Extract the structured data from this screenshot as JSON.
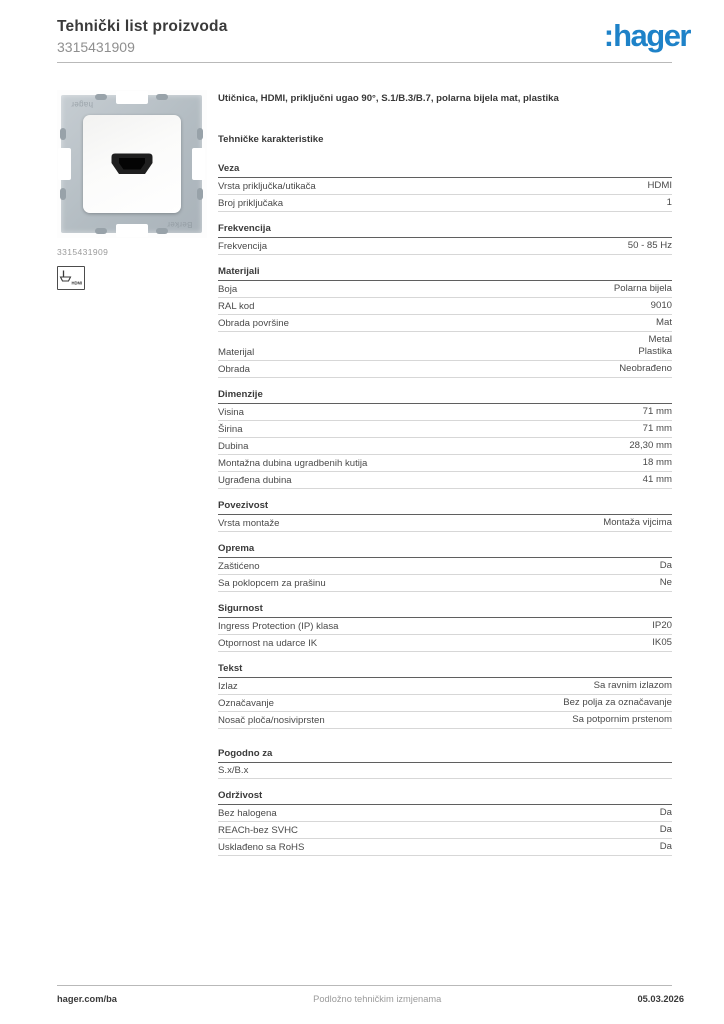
{
  "page": {
    "title": "Tehnički list proizvoda",
    "product_number": "3315431909"
  },
  "logo": {
    "prefix": ":",
    "text": "hager"
  },
  "product": {
    "description": "Utičnica, HDMI, priključni ugao 90°, S.1/B.3/B.7, polarna bijela mat, plastika",
    "image_caption": "3315431909",
    "image_watermark_top": "hager",
    "image_watermark_bottom": "Berker",
    "hdmi_icon_label": "HDMI"
  },
  "specs": {
    "title": "Tehničke karakteristike",
    "sections": [
      {
        "heading": "Veza",
        "rows": [
          {
            "label": "Vrsta priključka/utikača",
            "value": "HDMI"
          },
          {
            "label": "Broj priključaka",
            "value": "1"
          }
        ]
      },
      {
        "heading": "Frekvencija",
        "rows": [
          {
            "label": "Frekvencija",
            "value": "50 - 85 Hz"
          }
        ]
      },
      {
        "heading": "Materijali",
        "rows": [
          {
            "label": "Boja",
            "value": "Polarna bijela"
          },
          {
            "label": "RAL kod",
            "value": "9010"
          },
          {
            "label": "Obrada površine",
            "value": "Mat"
          },
          {
            "label": "Materijal",
            "value": "Metal\nPlastika"
          },
          {
            "label": "Obrada",
            "value": "Neobrađeno"
          }
        ]
      },
      {
        "heading": "Dimenzije",
        "rows": [
          {
            "label": "Visina",
            "value": "71 mm"
          },
          {
            "label": "Širina",
            "value": "71 mm"
          },
          {
            "label": "Dubina",
            "value": "28,30 mm"
          },
          {
            "label": "Montažna dubina ugradbenih kutija",
            "value": "18 mm"
          },
          {
            "label": "Ugrađena dubina",
            "value": "41 mm"
          }
        ]
      },
      {
        "heading": "Povezivost",
        "rows": [
          {
            "label": "Vrsta montaže",
            "value": "Montaža vijcima"
          }
        ]
      },
      {
        "heading": "Oprema",
        "rows": [
          {
            "label": "Zaštićeno",
            "value": "Da"
          },
          {
            "label": "Sa poklopcem za prašinu",
            "value": "Ne"
          }
        ]
      },
      {
        "heading": "Sigurnost",
        "rows": [
          {
            "label": "Ingress Protection (IP) klasa",
            "value": "IP20"
          },
          {
            "label": "Otpornost na udarce IK",
            "value": "IK05"
          }
        ]
      },
      {
        "heading": "Tekst",
        "rows": [
          {
            "label": "Izlaz",
            "value": "Sa ravnim izlazom"
          },
          {
            "label": "Označavanje",
            "value": "Bez polja za označavanje"
          },
          {
            "label": "Nosač ploča/nosiviprsten",
            "value": "Sa potpornim prstenom"
          }
        ]
      },
      {
        "heading": "Pogodno za",
        "extra_space": true,
        "rows": [
          {
            "label": "S.x/B.x",
            "value": ""
          }
        ]
      },
      {
        "heading": "Održivost",
        "rows": [
          {
            "label": "Bez halogena",
            "value": "Da"
          },
          {
            "label": "REACh-bez SVHC",
            "value": "Da"
          },
          {
            "label": "Usklađeno sa RoHS",
            "value": "Da"
          }
        ]
      }
    ]
  },
  "footer": {
    "left": "hager.com/ba",
    "center": "Podložno tehničkim izmjenama",
    "right": "05.03.2026"
  },
  "colors": {
    "brand_blue": "#1e82c8",
    "text_dark": "#3a3a3a",
    "text_gray": "#9a9a9a",
    "rule_light": "#d7d7d7",
    "rule_dark": "#5f5f5f"
  }
}
